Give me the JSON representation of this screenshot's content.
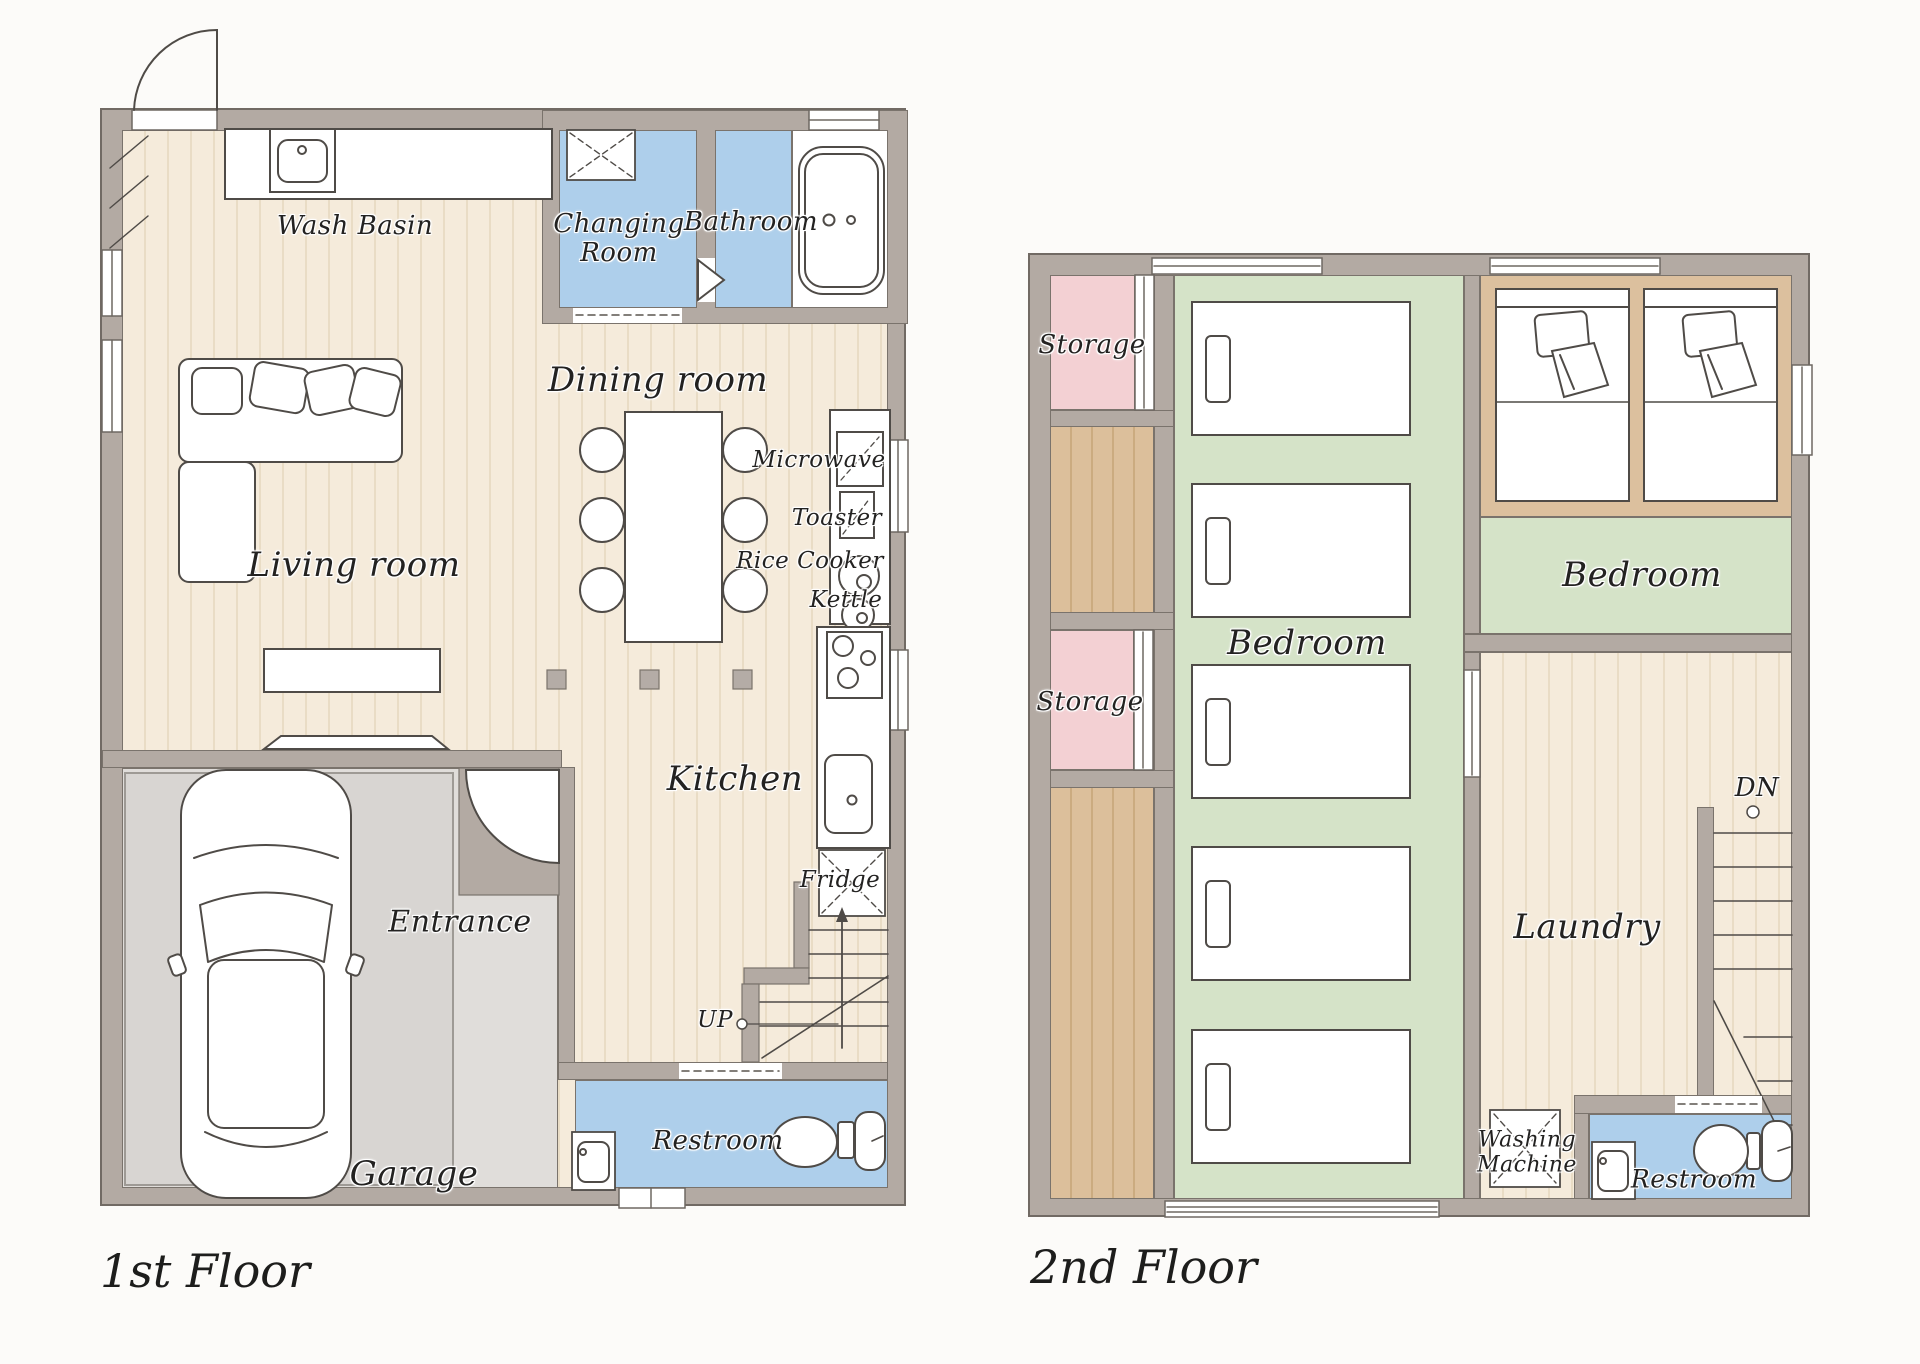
{
  "floor1": {
    "title": "1st Floor",
    "labels": {
      "wash_basin": "Wash Basin",
      "changing_room": "Changing\nRoom",
      "bathroom": "Bathroom",
      "dining_room": "Dining room",
      "living_room": "Living room",
      "kitchen": "Kitchen",
      "microwave": "Microwave",
      "toaster": "Toaster",
      "rice_cooker": "Rice Cooker",
      "kettle": "Kettle",
      "fridge": "Fridge",
      "up": "UP",
      "entrance": "Entrance",
      "garage": "Garage",
      "restroom": "Restroom"
    }
  },
  "floor2": {
    "title": "2nd Floor",
    "labels": {
      "storage_upper": "Storage",
      "storage_lower": "Storage",
      "bedroom_main": "Bedroom",
      "bedroom_twin": "Bedroom",
      "laundry": "Laundry",
      "down": "DN",
      "washing_machine": "Washing\nMachine",
      "restroom": "Restroom"
    }
  },
  "colors": {
    "wall": "#b3aaa3",
    "wood_floor": "#f5ebdb",
    "wet_room_blue": "#aecfeb",
    "storage_pink": "#f3d0d3",
    "bedroom_green": "#d5e3c8",
    "corridor_tan": "#dcbf9b",
    "garage_gray": "#d8d5d2",
    "entrance_gray": "#e0ddda"
  }
}
